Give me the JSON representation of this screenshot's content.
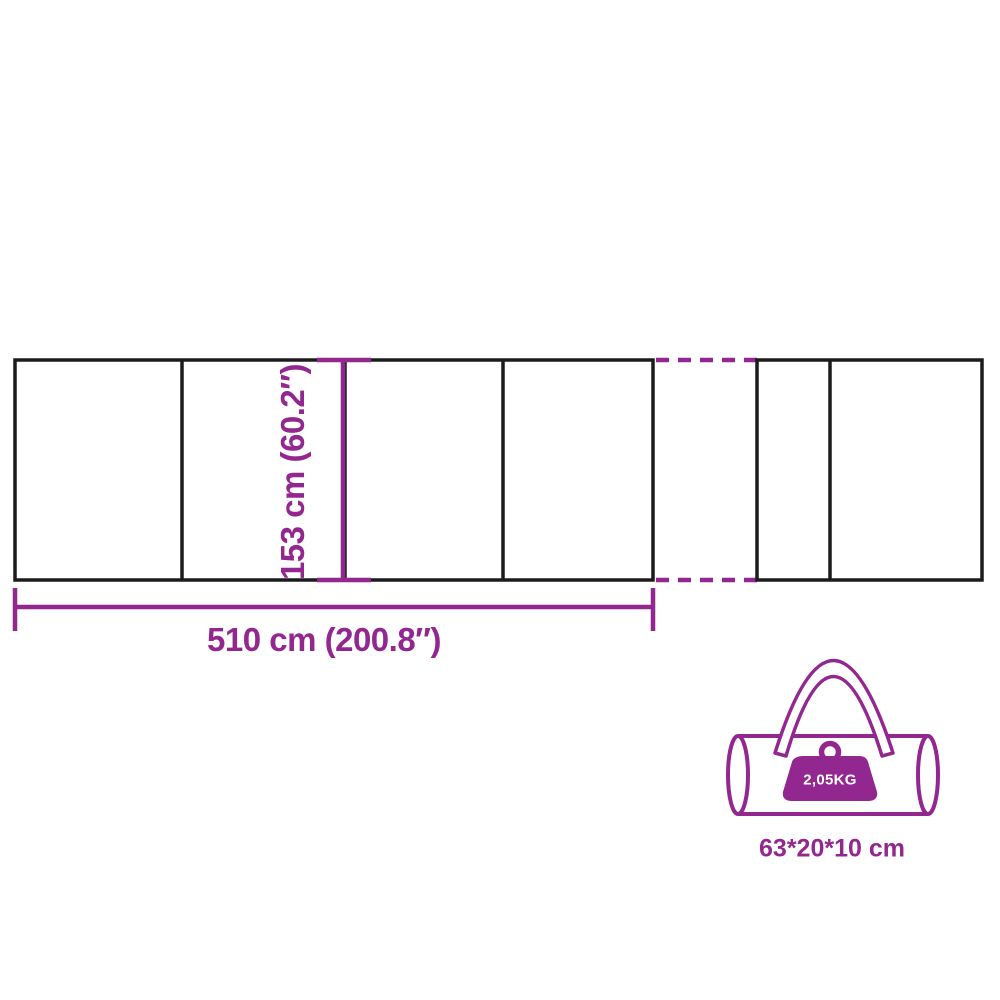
{
  "title": "Windbreak dimension diagram",
  "colors": {
    "accent": "#92278F",
    "outline": "#1B1B1B",
    "background": "#FFFFFF",
    "weight_text": "#FFFFFF"
  },
  "screen": {
    "height_label": "153 cm (60.2″)",
    "width_label": "510 cm (200.8″)"
  },
  "carry_bag": {
    "weight_label": "2,05KG",
    "dimensions_label": "63*20*10 cm"
  }
}
